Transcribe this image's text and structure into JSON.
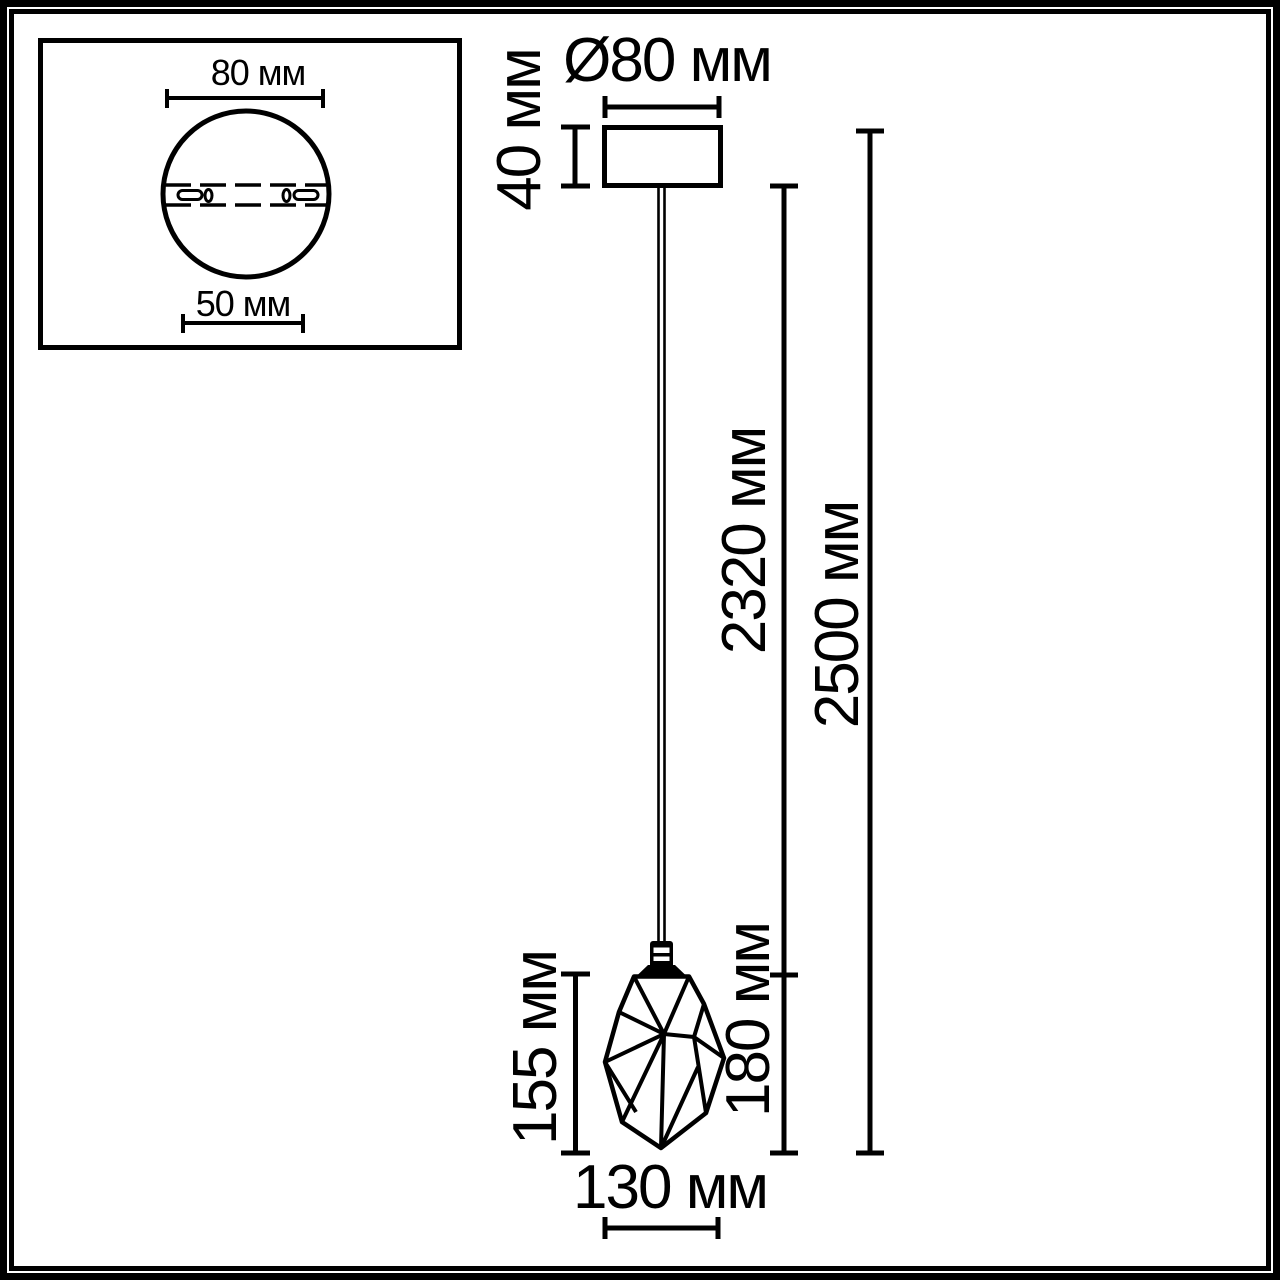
{
  "page": {
    "background": "#ffffff",
    "line_color": "#000000",
    "description": "Technical dimension drawing of a pendant lamp with faceted crystal shade"
  },
  "inset": {
    "plate_diameter_label": "80 мм",
    "hole_spacing_label": "50 мм"
  },
  "dimensions": {
    "canopy_diameter": "Ø80 мм",
    "canopy_height": "40 мм",
    "cord_length": "2320 мм",
    "overall_height": "2500 мм",
    "shade_height": "155 мм",
    "shade_with_socket": "180 мм",
    "shade_width": "130 мм"
  }
}
